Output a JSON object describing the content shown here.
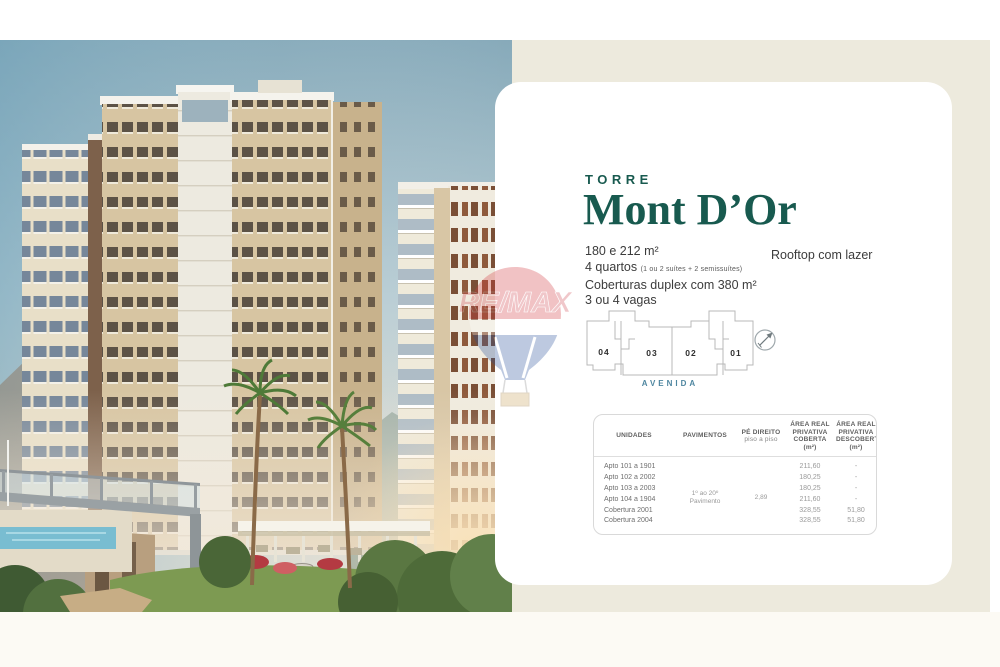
{
  "card": {
    "kicker": "TORRE",
    "title": "Mont D’Or",
    "specs": {
      "area": "180 e 212 m²",
      "rooms": "4 quartos",
      "rooms_note": "(1 ou 2 suítes + 2 semissuítes)",
      "penthouse": "Coberturas duplex com 380 m²",
      "parking": "3 ou 4 vagas"
    },
    "rooftop_note": "Rooftop com lazer",
    "floorplan": {
      "units": [
        "04",
        "03",
        "02",
        "01"
      ],
      "street_label": "AVENIDA"
    },
    "table": {
      "headers": {
        "unidades": "UNIDADES",
        "pavimentos": "PAVIMENTOS",
        "pe_direito": "PÉ DIREITO",
        "pe_direito_sub": "piso a piso",
        "area_coberta": "ÁREA REAL PRIVATIVA COBERTA (m²)",
        "area_descoberta": "ÁREA REAL PRIVATIVA DESCOBERTA (m²)"
      },
      "merged": {
        "pavimentos": "1º ao 20º Pavimento",
        "pe_direito": "2,89"
      },
      "rows": [
        {
          "unit": "Apto 101 a 1901",
          "coberta": "211,60",
          "descoberta": "-"
        },
        {
          "unit": "Apto 102 a 2002",
          "coberta": "180,25",
          "descoberta": "-"
        },
        {
          "unit": "Apto 103 a 2003",
          "coberta": "180,25",
          "descoberta": "-"
        },
        {
          "unit": "Apto 104 a 1904",
          "coberta": "211,60",
          "descoberta": "-"
        },
        {
          "unit": "Cobertura 2001",
          "coberta": "328,55",
          "descoberta": "51,80"
        },
        {
          "unit": "Cobertura 2004",
          "coberta": "328,55",
          "descoberta": "51,80"
        }
      ]
    }
  },
  "watermark": {
    "label": "RE/MAX"
  },
  "colors": {
    "accent_teal": "#185a4f",
    "street_blue": "#4e86a0",
    "panel_beige": "#edeadd",
    "remax_red": "#d3383f",
    "remax_blue": "#27509b"
  }
}
